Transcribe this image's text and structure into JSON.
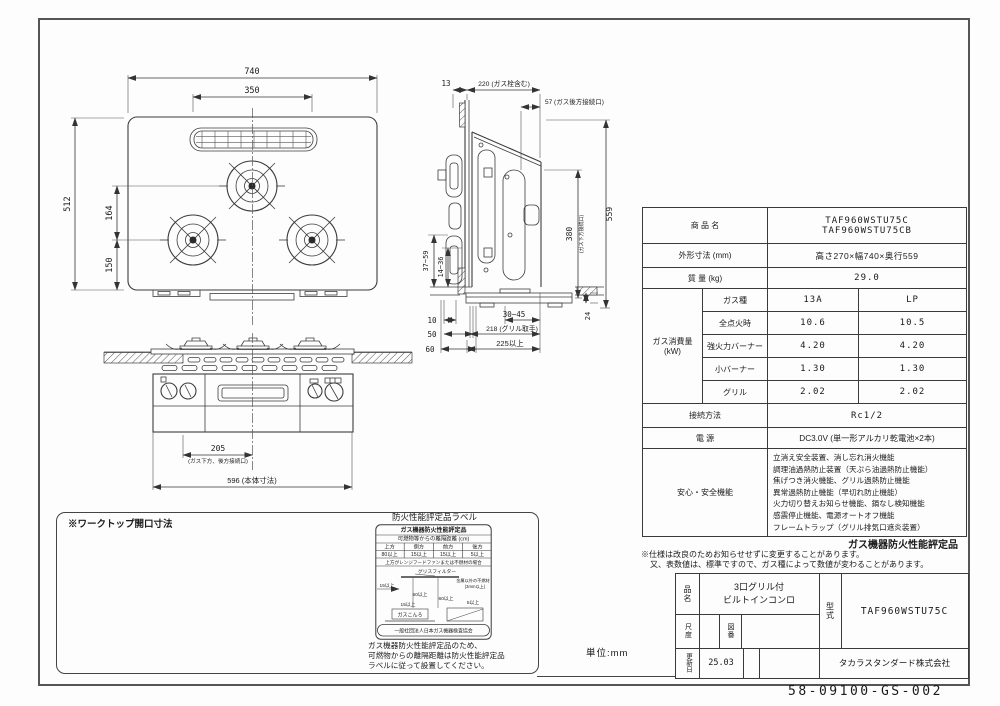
{
  "drawing": {
    "frame_number": "58-09100-GS-002",
    "unit_note": "単位:mm"
  },
  "top_view": {
    "d740": "740",
    "d350": "350",
    "d512": "512",
    "d164": "164",
    "d150": "150"
  },
  "side_view": {
    "d13": "13",
    "d220": "220 (ガス栓含む)",
    "d57": "57 (ガス後方接続口)",
    "d559": "559",
    "d380": "380",
    "d380_note": "(ガス下方接続口)",
    "d37_59": "37~59",
    "d14_36": "14~36",
    "d10": "10",
    "d50": "50",
    "d60": "60",
    "d30_45": "30~45",
    "d218": "218 (グリル取手)",
    "d225": "225以上",
    "d24": "24"
  },
  "front_view": {
    "d205": "205",
    "d205_note": "(ガス下方、後方接続口)",
    "d596": "596 (本体寸法)"
  },
  "worktop": {
    "title": "※ワークトップ開口寸法",
    "d560": "560",
    "tol_plus": "+4",
    "tol_minus": "-0",
    "d460": "460",
    "corner": "4-R10~30",
    "d600": "600以上",
    "front_label": "ワークトップ前面",
    "a_plus": "A+37~59",
    "d15_45": "15~45",
    "d37_59": "37~59",
    "d30_45": "30~45",
    "a_label": "A",
    "cabinet_label": "キャビネット扉前面",
    "d225": "225以上"
  },
  "fire_label": {
    "title": "防火性能評定品ラベル",
    "header": "ガス機器防火性能評定品",
    "subheader": "可燃物等からの離隔距離 (cm)",
    "columns": [
      "上方",
      "側方",
      "前方",
      "後方"
    ],
    "values": [
      "80以上",
      "15以上",
      "15以上",
      "5以上"
    ],
    "condition": "上方がレンジフードファンまたは不燃材の場合",
    "grease_filter": "グリスフィルター",
    "metal_note": "金属以外の不燃材",
    "metal_note2": "(3mm以上)",
    "dim_15a": "15以上",
    "dim_60a": "60以上",
    "dim_60b": "60以上",
    "dim_15b": "15以上",
    "dim_5": "5以上",
    "stove": "ガスこんろ",
    "org": "一般社団法人日本ガス機器検査協会",
    "note1": "ガス機器防火性能評定品のため、",
    "note2": "可燃物からの離隔距離は防火性能評定品",
    "note3": "ラベルに従って設置してください。"
  },
  "spec_table": {
    "product_label": "商 品 名",
    "product_value1": "TAF960WSTU75C",
    "product_value2": "TAF960WSTU75CB",
    "dims_label": "外形寸法 (mm)",
    "dims_value": "高さ270×幅740×奥行559",
    "weight_label": "質 量 (kg)",
    "weight_value": "29.0",
    "gas_group_label1": "ガス消費量",
    "gas_group_label2": "(kW)",
    "gas_rows": [
      {
        "label": "ガス種",
        "v13a": "13A",
        "vlp": "LP"
      },
      {
        "label": "全点火時",
        "v13a": "10.6",
        "vlp": "10.5"
      },
      {
        "label": "強火力バーナー",
        "v13a": "4.20",
        "vlp": "4.20"
      },
      {
        "label": "小バーナー",
        "v13a": "1.30",
        "vlp": "1.30"
      },
      {
        "label": "グリル",
        "v13a": "2.02",
        "vlp": "2.02"
      }
    ],
    "connect_label": "接続方法",
    "connect_value": "Rc1/2",
    "power_label": "電 源",
    "power_value": "DC3.0V (単一形アルカリ乾電池×2本)",
    "safety_label": "安心・安全機能",
    "safety_lines": [
      "立消え安全装置、消し忘れ消火機能",
      "調理油過熱防止装置（天ぷら油過熱防止機能）",
      "焦げつき消火機能、グリル過熱防止機能",
      "異常過熱防止機能（早切れ防止機能）",
      "火力切り替えお知らせ機能、鍋なし検知機能",
      "感震停止機能、電源オートオフ機能",
      "フレームトラップ（グリル排気口遮炎装置）"
    ],
    "cert_note": "ガス機器防火性能評定品",
    "remark1": "※仕様は改良のためお知らせせずに変更することがあります。",
    "remark2": "又、表数値は、標準ですので、ガス種によって数値が変わることがあります。"
  },
  "title_block": {
    "name_label": "品名",
    "name_value1": "3口グリル付",
    "name_value2": "ビルトインコンロ",
    "model_label": "型式",
    "model_value": "TAF960WSTU75C",
    "scale_label": "尺度",
    "fig_label": "図番",
    "update_label": "更新日",
    "update_value": "25.03",
    "company": "タカラスタンダード株式会社"
  }
}
